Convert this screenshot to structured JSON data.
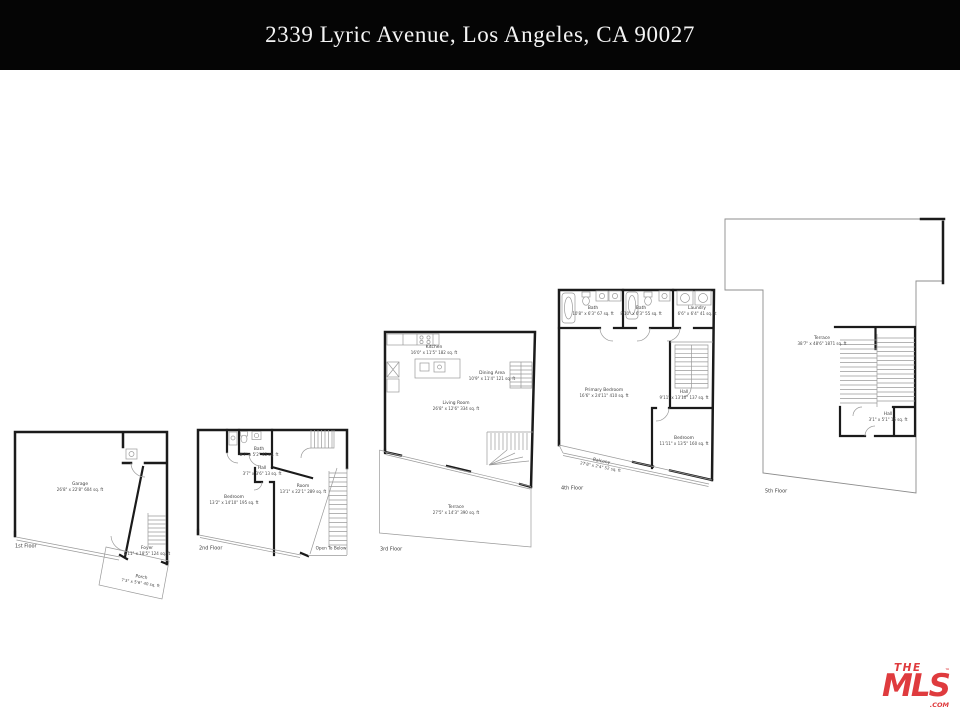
{
  "header": {
    "title": "2339 Lyric Avenue, Los Angeles, CA 90027"
  },
  "colors": {
    "header_bg": "#050505",
    "header_text": "#f4f4f4",
    "wall": "#1b1b1b",
    "thin_line": "#9a9a9a",
    "label_text": "#3d3d3d",
    "logo_red": "#df3b3e"
  },
  "logo": {
    "the": "THE",
    "mls": "MLS",
    "tm": "™",
    "com": ".COM"
  },
  "floors": [
    {
      "label": "1st Floor",
      "rooms": [
        {
          "name": "Garage",
          "dims": "26'8\" x 22'8\" 604 sq. ft"
        },
        {
          "name": "Foyer",
          "dims": "6'11\" x 18'5\" 124 sq. ft"
        },
        {
          "name": "Porch",
          "dims": "7'3\" x 5'6\" 40 sq. ft"
        }
      ]
    },
    {
      "label": "2nd Floor",
      "rooms": [
        {
          "name": "Bath",
          "dims": "8'7\" x 5'2\" 45 sq. ft"
        },
        {
          "name": "Hall",
          "dims": "3'7\" x 3'6\" 13 sq. ft"
        },
        {
          "name": "Bedroom",
          "dims": "13'2\" x 14'10\" 195 sq. ft"
        },
        {
          "name": "Room",
          "dims": "13'1\" x 22'1\" 289 sq. ft"
        }
      ],
      "annotations": [
        "Open To Below"
      ]
    },
    {
      "label": "3rd Floor",
      "rooms": [
        {
          "name": "Kitchen",
          "dims": "16'0\" x 11'5\" 182 sq. ft"
        },
        {
          "name": "Dining Area",
          "dims": "10'9\" x 11'4\" 121 sq. ft"
        },
        {
          "name": "Living Room",
          "dims": "26'8\" x 12'6\" 334 sq. ft"
        },
        {
          "name": "Terrace",
          "dims": "27'5\" x 14'3\" 390 sq. ft"
        }
      ]
    },
    {
      "label": "4th Floor",
      "rooms": [
        {
          "name": "Bath",
          "dims": "10'8\" x 6'3\" 67 sq. ft"
        },
        {
          "name": "Bath",
          "dims": "8'10\" x 6'3\" 55 sq. ft"
        },
        {
          "name": "Laundry",
          "dims": "6'6\" x 6'4\" 41 sq. ft"
        },
        {
          "name": "Primary Bedroom",
          "dims": "16'6\" x 24'11\" 410 sq. ft"
        },
        {
          "name": "Hall",
          "dims": "9'11\" x 13'10\" 137 sq. ft"
        },
        {
          "name": "Bedroom",
          "dims": "11'11\" x 13'5\" 160 sq. ft"
        },
        {
          "name": "Balcony",
          "dims": "27'8\" x 2'4\" 52 sq. ft"
        }
      ]
    },
    {
      "label": "5th Floor",
      "rooms": [
        {
          "name": "Terrace",
          "dims": "38'7\" x 48'6\" 1871 sq. ft"
        },
        {
          "name": "Hall",
          "dims": "3'1\" x 5'1\" 16 sq. ft"
        }
      ]
    }
  ]
}
